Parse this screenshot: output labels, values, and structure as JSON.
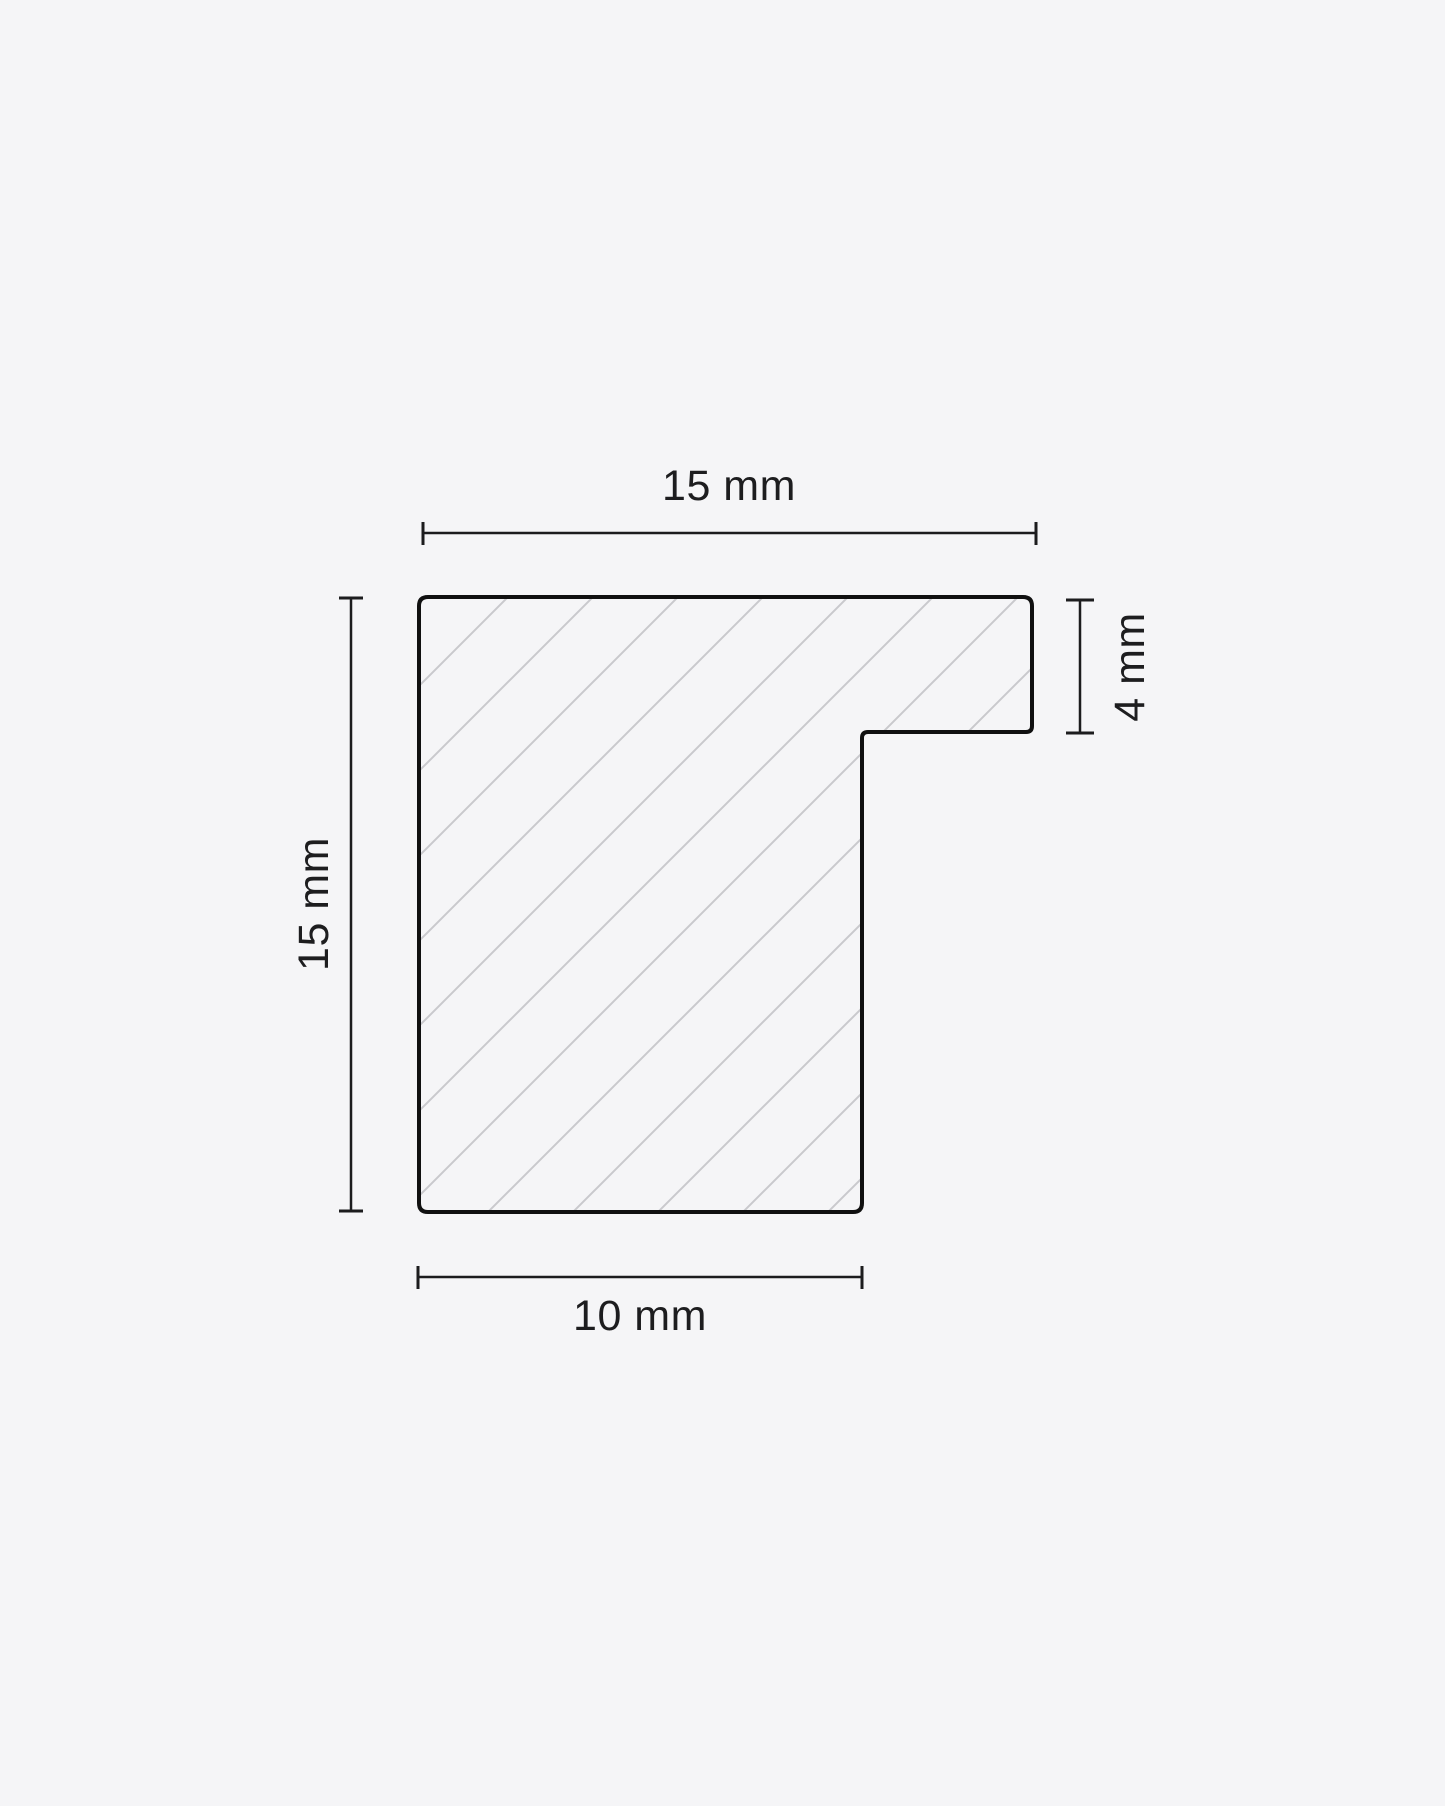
{
  "page": {
    "background_color": "#f5f5f7"
  },
  "diagram": {
    "name": "frame-moulding-profile-cross-section",
    "outline_color": "#101010",
    "hatch_color": "#c9c9cd",
    "dimension_line_color": "#1c1c1e",
    "text_color": "#1d1d1f",
    "profile": {
      "overall_width_mm": 15,
      "overall_height_mm": 15,
      "rabbet_lip_thickness_mm": 4,
      "base_width_mm": 10
    },
    "dimensions": {
      "top": {
        "label": "15 mm",
        "value": 15,
        "unit": "mm",
        "orientation": "horizontal"
      },
      "left": {
        "label": "15 mm",
        "value": 15,
        "unit": "mm",
        "orientation": "vertical"
      },
      "right": {
        "label": "4 mm",
        "value": 4,
        "unit": "mm",
        "orientation": "vertical"
      },
      "bottom": {
        "label": "10 mm",
        "value": 10,
        "unit": "mm",
        "orientation": "horizontal"
      }
    }
  }
}
